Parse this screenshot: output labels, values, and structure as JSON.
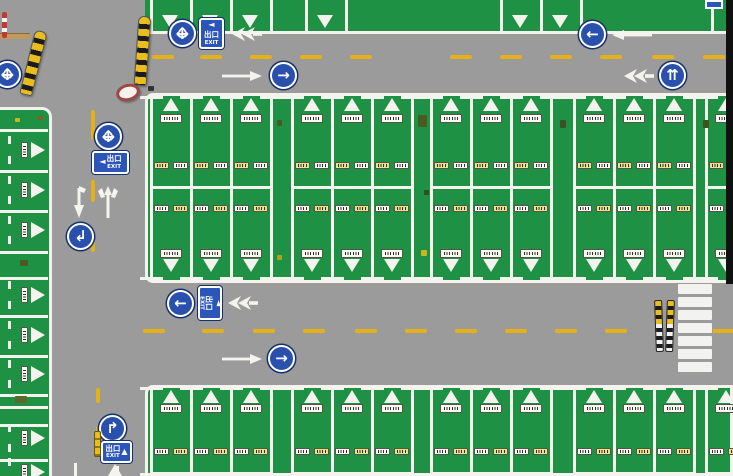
{
  "scene": {
    "w": 733,
    "h": 476,
    "description": "aerial top-down view of bus parking depot"
  },
  "colors": {
    "road": "#9b9b9b",
    "green": "#1e9144",
    "line_white": "#f4f3ee",
    "lane_yellow": "#e5b117",
    "sign_blue": "#2a50ae",
    "sign_navy": "#17306b",
    "exit_blue": "#2b55b8",
    "black_band": "#101010",
    "plate_white": "#fbfaf2",
    "plate_yellow": "#e7e388",
    "plate_border": "#55544a",
    "smudge": "#2f2f2f",
    "pole_yellow": "#e9bd1d",
    "pole_black": "#1c1c1c",
    "pole_white": "#f2f2f2",
    "tan": "#c09a5c",
    "red": "#c03a34",
    "crosswalk_white": "#f2f2f0"
  },
  "top_strip": {
    "x": 145,
    "y": 0,
    "w": 588,
    "h": 34,
    "border_bottom_y": 31,
    "dividers": [
      150,
      190,
      230,
      270,
      305,
      345,
      500,
      540,
      580,
      711
    ],
    "triangles": [
      170,
      210,
      250,
      325,
      520,
      560
    ]
  },
  "main_block": {
    "x": 145,
    "y": 93,
    "w": 588,
    "h": 190,
    "groups": [
      {
        "x": 150,
        "cols": 3
      },
      {
        "x": 291,
        "cols": 3
      },
      {
        "x": 430,
        "cols": 3
      },
      {
        "x": 573,
        "cols": 3
      },
      {
        "x": 705,
        "cols": 1
      }
    ],
    "col_w": 40,
    "v_top": 96,
    "v_bot": 280,
    "mid_y": 186,
    "tri_top_y": 98,
    "plate_top_y": 114,
    "label_up_y": 162,
    "label_low_y": 205,
    "plate_bot_y": 249,
    "tri_bot_y": 259
  },
  "bottom_block": {
    "x": 145,
    "y": 385,
    "w": 588,
    "h": 91,
    "groups": [
      {
        "x": 150,
        "cols": 3
      },
      {
        "x": 291,
        "cols": 3
      },
      {
        "x": 430,
        "cols": 3
      },
      {
        "x": 573,
        "cols": 3
      },
      {
        "x": 705,
        "cols": 1
      }
    ],
    "col_w": 40,
    "v_top": 387,
    "v_bot": 476,
    "tri_top_y": 390,
    "plate_top_y": 404,
    "label_up_y": 448,
    "mid_y": 472
  },
  "left_strip": {
    "x": 0,
    "y": 107,
    "w": 52,
    "h": 369,
    "separators": [
      129,
      170,
      210,
      251,
      277,
      315,
      355,
      394,
      406,
      424,
      459
    ],
    "bays": [
      150,
      190,
      230,
      295,
      335,
      374,
      438,
      472
    ]
  },
  "road_marks": {
    "top_dashes": {
      "y": 55,
      "h": 4,
      "w": 22,
      "x": [
        152,
        200,
        250,
        300,
        350,
        450,
        500,
        550,
        600,
        652,
        703
      ]
    },
    "mid_dashes": {
      "y": 329,
      "h": 4,
      "w": 22,
      "x": [
        143,
        202,
        253,
        303,
        355,
        405,
        455,
        505,
        555,
        605
      ],
      "extra": {
        "x": 713,
        "w": 20
      }
    },
    "left_dashes": [
      {
        "x": 91,
        "y": 110,
        "h": 30
      },
      {
        "x": 91,
        "y": 180,
        "h": 22
      },
      {
        "x": 91,
        "y": 230,
        "h": 22
      },
      {
        "x": 96,
        "y": 388,
        "h": 15
      },
      {
        "x": 96,
        "y": 426,
        "h": 15
      }
    ],
    "white_dashes": [
      {
        "x": 74,
        "y": 463,
        "w": 3,
        "h": 13
      },
      {
        "x": 116,
        "y": 466,
        "w": 3,
        "h": 10
      }
    ],
    "tan_bar": {
      "x": 0,
      "y": 33,
      "w": 30,
      "h": 6
    }
  },
  "signs": [
    {
      "type": "cross",
      "name": "sign-crossroads",
      "x": 182,
      "y": 33
    },
    {
      "type": "arrow",
      "name": "sign-go-right",
      "glyph": "→",
      "x": 283,
      "y": 75
    },
    {
      "type": "arrow",
      "name": "sign-go-left",
      "glyph": "←",
      "x": 592,
      "y": 34
    },
    {
      "type": "arrow",
      "name": "sign-fork-ahead",
      "glyph": "⇈",
      "x": 672,
      "y": 75
    },
    {
      "type": "cross",
      "name": "sign-crossroads",
      "x": 108,
      "y": 136
    },
    {
      "type": "arrow",
      "name": "sign-turn-down-left",
      "glyph": "↲",
      "x": 80,
      "y": 236
    },
    {
      "type": "arrow",
      "name": "sign-go-left",
      "glyph": "←",
      "x": 180,
      "y": 303
    },
    {
      "type": "arrow",
      "name": "sign-go-right",
      "glyph": "→",
      "x": 281,
      "y": 358
    },
    {
      "type": "arrow",
      "name": "sign-turn-right",
      "glyph": "↱",
      "x": 112,
      "y": 428
    },
    {
      "type": "cross",
      "name": "sign-crossroads",
      "x": 7,
      "y": 74
    }
  ],
  "exit_signs": [
    {
      "x": 199,
      "y": 18,
      "w": 25,
      "h": 31,
      "variant": "v",
      "arrow": "◄",
      "cn": "出口",
      "en": "EXIT"
    },
    {
      "x": 92,
      "y": 151,
      "w": 37,
      "h": 23,
      "variant": "h-left",
      "arrow": "◄",
      "cn": "出口",
      "en": "EXIT"
    },
    {
      "x": 198,
      "y": 286,
      "w": 24,
      "h": 34,
      "variant": "v-rot",
      "arrow": "◄",
      "cn": "出口",
      "en": "EXIT"
    },
    {
      "x": 101,
      "y": 441,
      "w": 31,
      "h": 22,
      "variant": "h-up",
      "arrow": "▲",
      "cn": "出口",
      "en": "EXIT"
    }
  ],
  "markings": [
    {
      "type": "dart-left",
      "x": 232,
      "y": 27
    },
    {
      "type": "arrow-right",
      "x": 222,
      "y": 71
    },
    {
      "type": "arrow-left",
      "x": 612,
      "y": 30
    },
    {
      "type": "dart-left",
      "x": 624,
      "y": 69
    },
    {
      "type": "dart-left",
      "x": 228,
      "y": 296
    },
    {
      "type": "arrow-right",
      "x": 222,
      "y": 354
    },
    {
      "type": "arrow-down",
      "x": 70,
      "y": 186
    },
    {
      "type": "trident-up",
      "x": 97,
      "y": 186
    },
    {
      "type": "tri-up",
      "x": 108,
      "y": 464
    }
  ],
  "crosswalk": {
    "x": 678,
    "y": 284,
    "w": 34,
    "stripe_h": 10,
    "gap": 3,
    "count": 7
  },
  "poles": {
    "crosswalk": [
      {
        "x": 655,
        "y": 300,
        "rot": -2
      },
      {
        "x": 666,
        "y": 300,
        "rot": 2
      }
    ],
    "cw_w": 8,
    "cw_h": 52,
    "striped": [
      {
        "x": 27,
        "y": 30,
        "w": 13,
        "h": 66,
        "rot": 14
      },
      {
        "x": 136,
        "y": 16,
        "w": 13,
        "h": 70,
        "rot": 4
      }
    ],
    "yellow_small": {
      "x": 94,
      "y": 431,
      "w": 7,
      "h": 26
    },
    "red_small": {
      "x": 2,
      "y": 12,
      "w": 5,
      "h": 26
    }
  },
  "props": {
    "round_object": {
      "x": 116,
      "y": 84,
      "w": 24,
      "h": 17,
      "rot": -15
    },
    "dark_band": {
      "x": 726,
      "y": 0,
      "w": 7,
      "h": 284
    },
    "corner_sign": {
      "x": 705,
      "y": 0,
      "w": 18,
      "h": 9
    }
  },
  "specks": [
    {
      "x": 418,
      "y": 115,
      "w": 9,
      "h": 12,
      "c": "#4a5a20"
    },
    {
      "x": 421,
      "y": 250,
      "w": 6,
      "h": 6,
      "c": "#c8b820"
    },
    {
      "x": 424,
      "y": 190,
      "w": 5,
      "h": 5,
      "c": "#3a4a1a"
    },
    {
      "x": 560,
      "y": 120,
      "w": 6,
      "h": 8,
      "c": "#3c5222"
    },
    {
      "x": 703,
      "y": 120,
      "w": 6,
      "h": 8,
      "c": "#3c5222"
    },
    {
      "x": 15,
      "y": 396,
      "w": 12,
      "h": 7,
      "c": "#5a6a28"
    },
    {
      "x": 20,
      "y": 260,
      "w": 8,
      "h": 6,
      "c": "#4a5a20"
    },
    {
      "x": 148,
      "y": 86,
      "w": 6,
      "h": 5,
      "c": "#333333"
    },
    {
      "x": 277,
      "y": 120,
      "w": 5,
      "h": 6,
      "c": "#4a5a20"
    },
    {
      "x": 277,
      "y": 255,
      "w": 5,
      "h": 5,
      "c": "#b0a020"
    },
    {
      "x": 15,
      "y": 118,
      "w": 5,
      "h": 4,
      "c": "#c8b820"
    },
    {
      "x": 38,
      "y": 116,
      "w": 5,
      "h": 4,
      "c": "#8a5a20"
    }
  ]
}
